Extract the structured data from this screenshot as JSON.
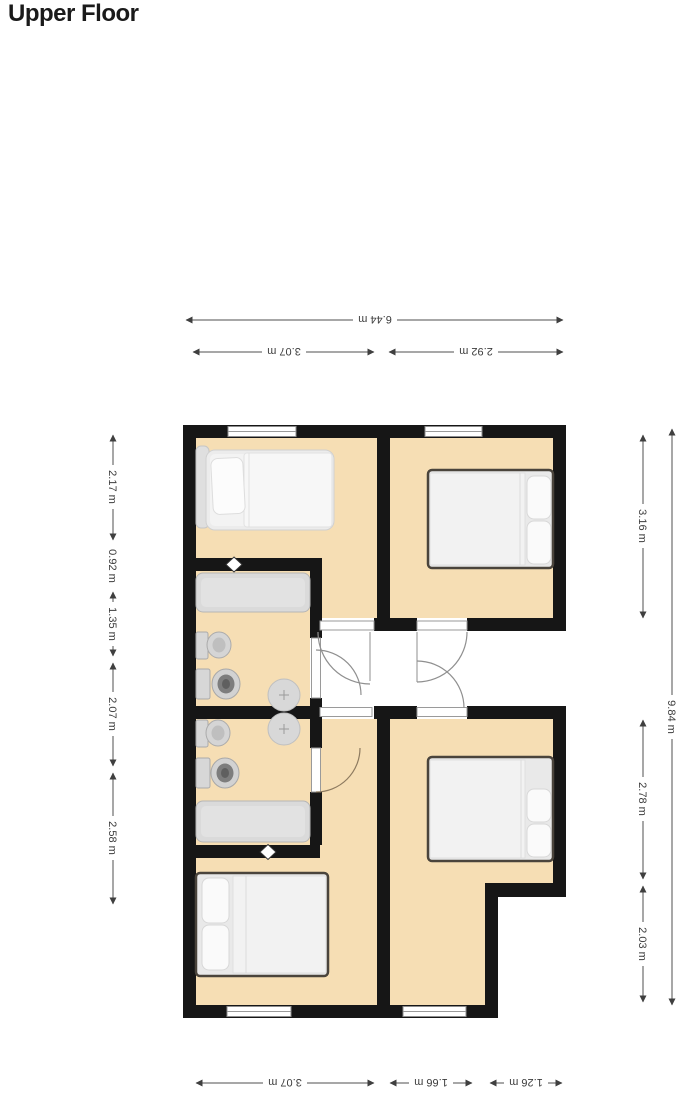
{
  "page": {
    "title": "Upper Floor"
  },
  "colors": {
    "background": "#ffffff",
    "floor": "#f6deb4",
    "wall": "#161616",
    "dimension_text": "#3c3c3c",
    "bed_frame_dark": "#4a443c",
    "fixture_gray": "#d8d8d8",
    "title_text": "#1a1a1a"
  },
  "floor_plan": {
    "dimensions": {
      "top": [
        {
          "label": "6.44 m"
        },
        {
          "label": "3.07 m"
        },
        {
          "label": "2.92 m"
        }
      ],
      "bottom": [
        {
          "label": "3.07 m"
        },
        {
          "label": "1.66 m"
        },
        {
          "label": "1.26 m"
        }
      ],
      "left": [
        {
          "label": "2.17 m"
        },
        {
          "label": "0.92 m"
        },
        {
          "label": "1.35 m"
        },
        {
          "label": "2.07 m"
        },
        {
          "label": "2.58 m"
        }
      ],
      "right": [
        {
          "label": "3.16 m"
        },
        {
          "label": "2.78 m"
        },
        {
          "label": "2.03 m"
        }
      ],
      "right_overall": {
        "label": "9.84 m"
      }
    },
    "fixtures": {
      "beds": [
        "single-bed",
        "double-bed",
        "double-bed",
        "double-bed"
      ],
      "bathroom_items": [
        "bathtub",
        "bathtub",
        "toilet",
        "toilet",
        "bidet",
        "bidet",
        "washbasin",
        "washbasin"
      ],
      "wall_symbols": [
        "diamond-vent",
        "diamond-vent"
      ],
      "window_count": 4,
      "door_count": 6
    }
  }
}
